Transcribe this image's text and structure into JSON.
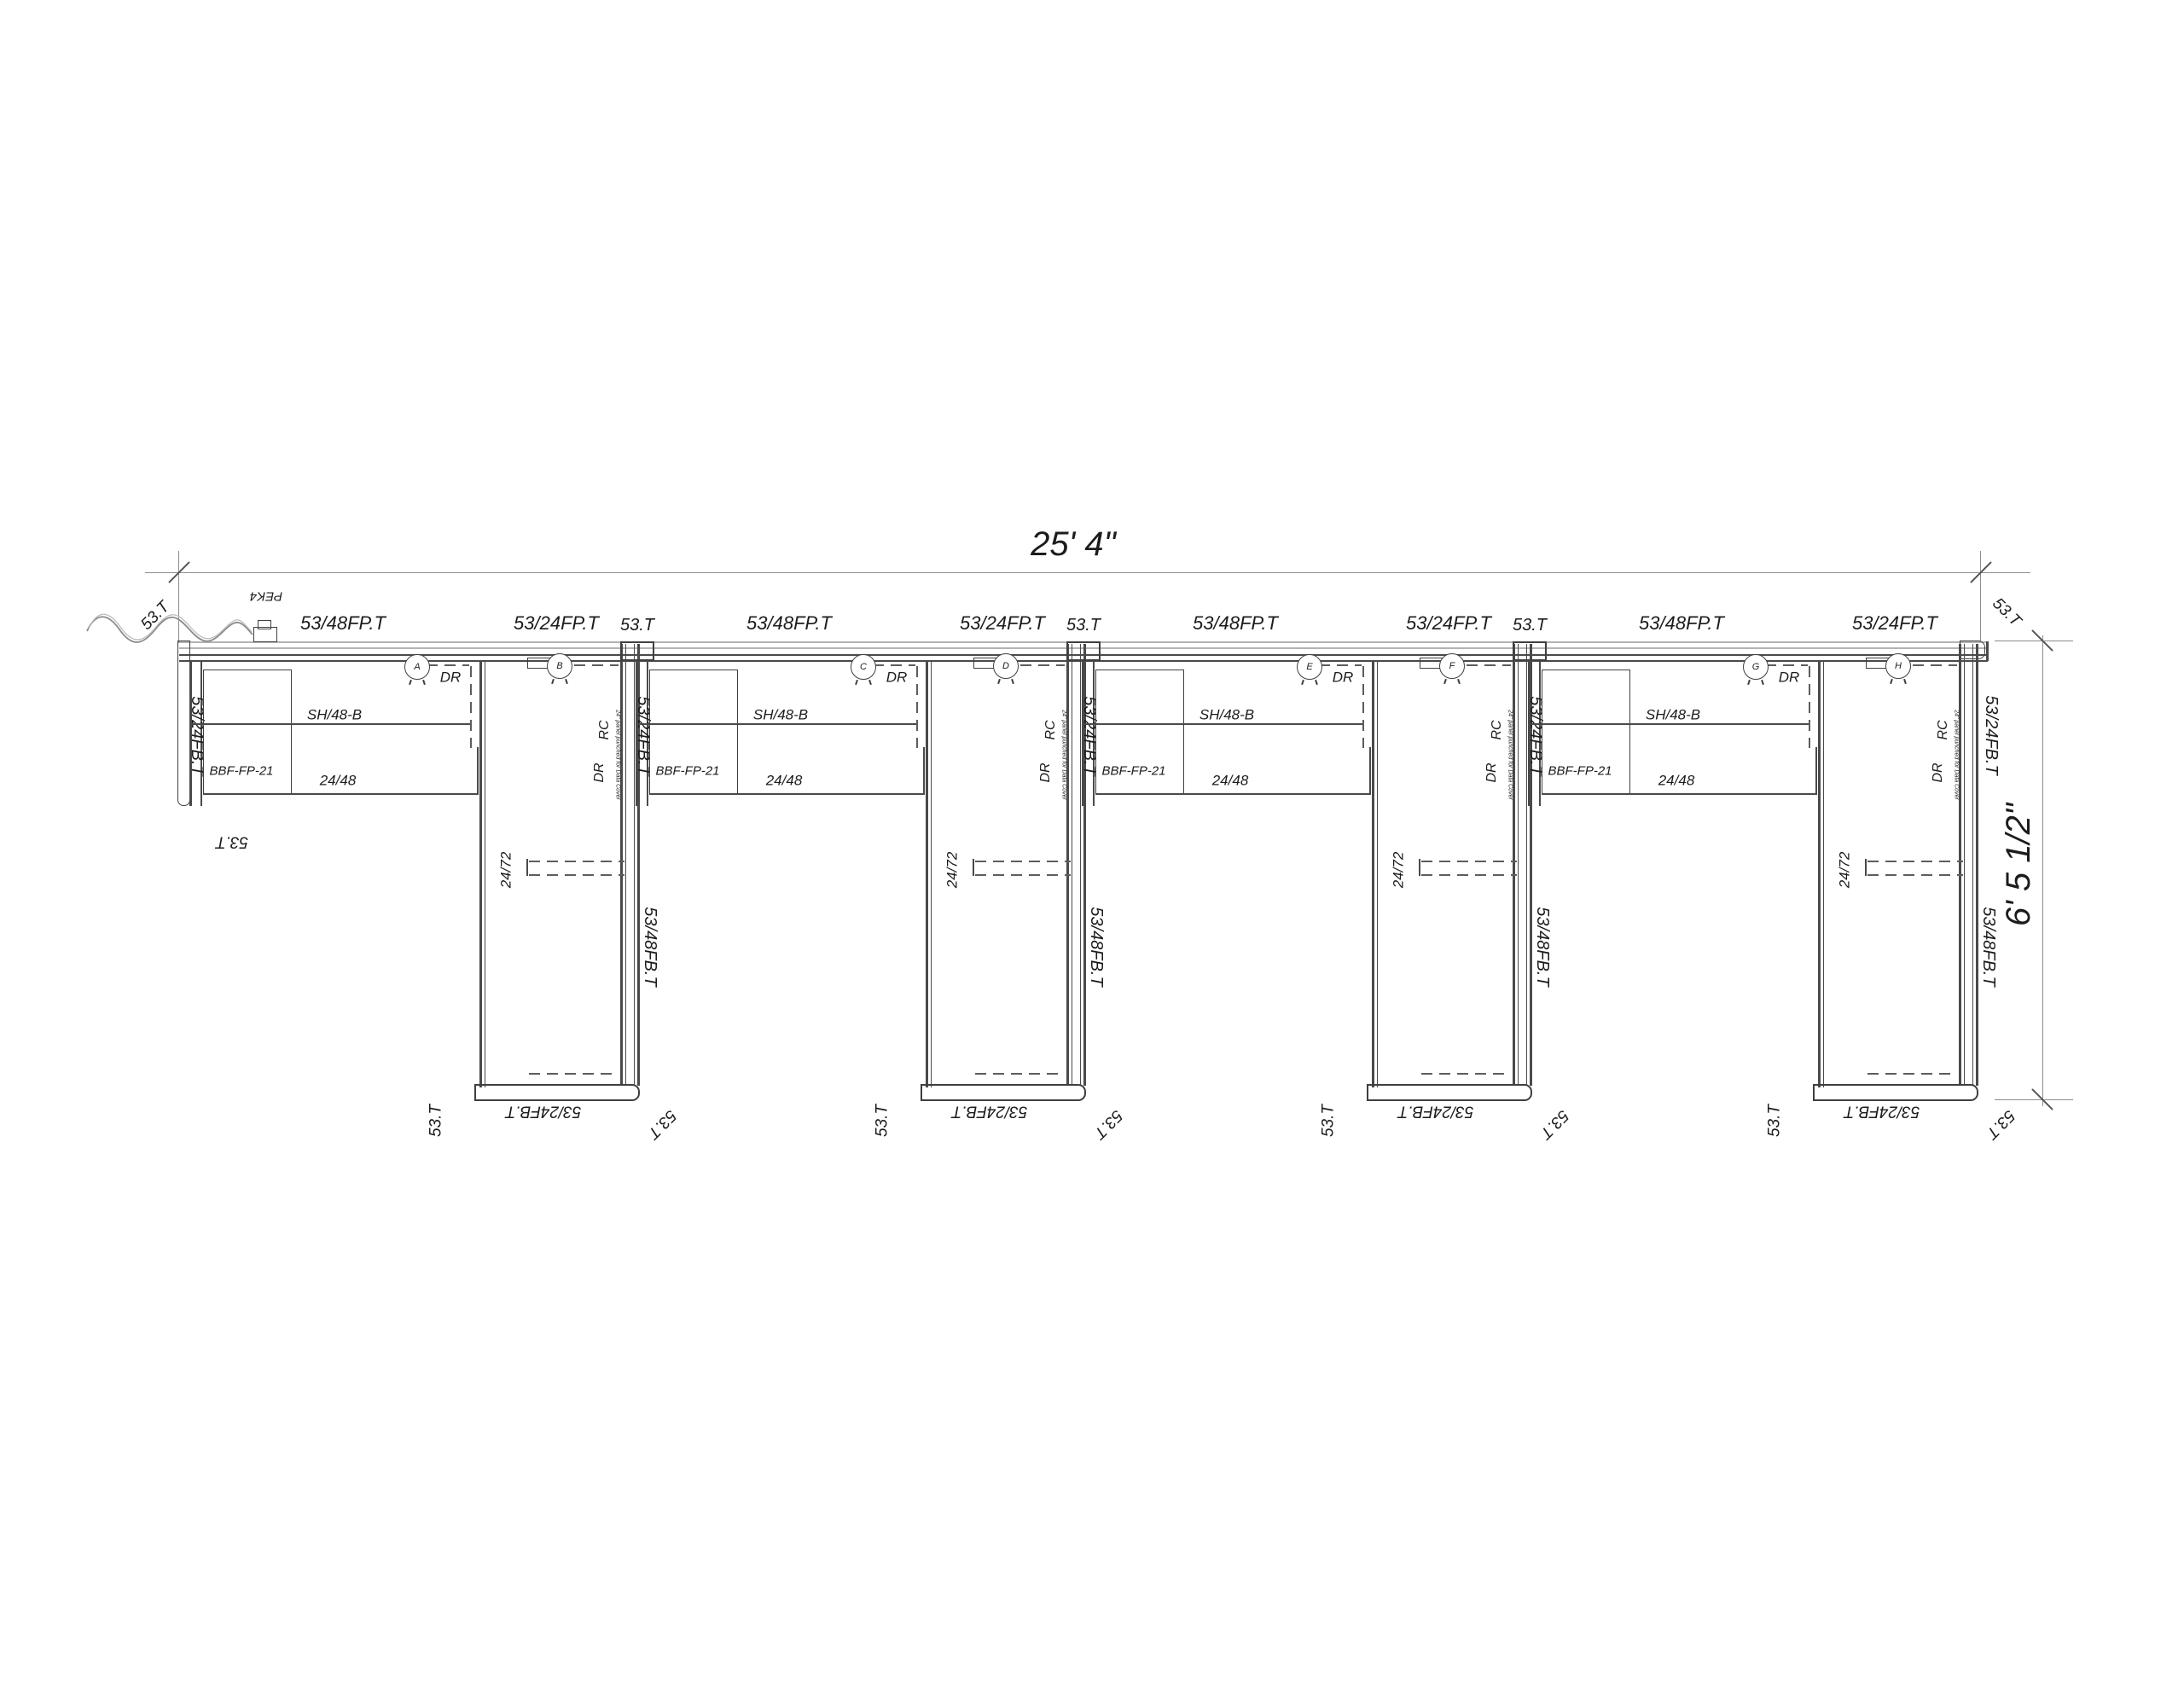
{
  "dimensions": {
    "horizontal": "25' 4\"",
    "vertical": "6' 5 1/2\""
  },
  "shared": {
    "run_top": "53/48FP.T",
    "wing_top": "53/24FP.T",
    "post": "53.T",
    "tag": "53.T",
    "left_panel": "53/24FB.T",
    "wing_side": "53/48FB.T",
    "wing_bottom": "53/24FB.T",
    "right_end_panel": "53/24FB.T",
    "shelf": "SH/48-B",
    "pedestal": "BBF-FP-21",
    "worksurface": "24/48",
    "wing_worksurface": "24/72",
    "rc": "RC",
    "dr": "DR",
    "panel_note": "24\" panel punched for Data Cover",
    "power_entry": "PEK4"
  },
  "stations": [
    {
      "module_grommet": "A",
      "wing_grommet": "B"
    },
    {
      "module_grommet": "C",
      "wing_grommet": "D"
    },
    {
      "module_grommet": "E",
      "wing_grommet": "F"
    },
    {
      "module_grommet": "G",
      "wing_grommet": "H"
    }
  ]
}
